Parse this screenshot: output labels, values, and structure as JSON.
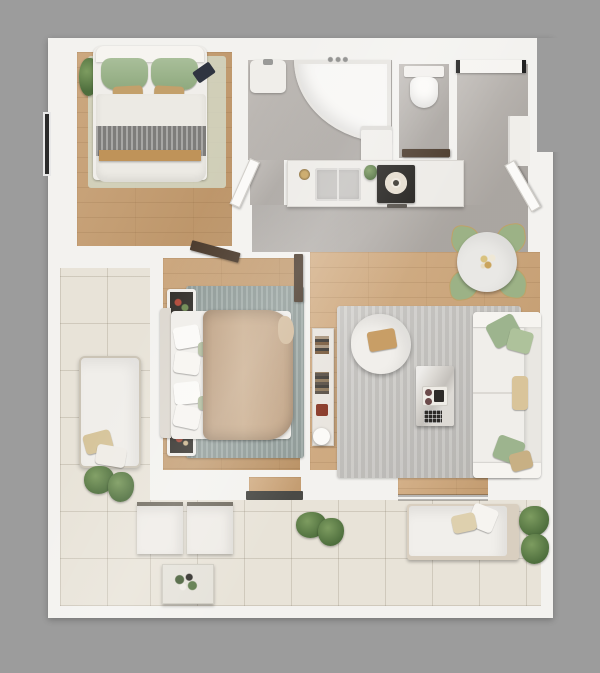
{
  "meta": {
    "title": "apartment-floor-plan-top-view-render",
    "canvas": {
      "width": 600,
      "height": 673
    },
    "visible_text": []
  },
  "palette": {
    "background": "#9c9c9c",
    "wall_white": "#f3f2ef",
    "wood_floor": "#cda476",
    "wood_floor_bedroom": "#c49a6b",
    "concrete_gray": "#b7b2ad",
    "terrace_tile": "#e8e3d8",
    "rug_living": "#c7c5c1",
    "rug_bedroom2": "#98a4a0",
    "rug_bedroom1": "#d4d8c6",
    "sage_green": "#9db48e",
    "tan": "#c3a06b",
    "camel_blanket": "#c4a98b",
    "gray_throw": "#8f8e8c",
    "door_walnut": "#4b3b2d",
    "cooktop_black": "#24221f",
    "brass": "#b08d4f",
    "plant_green": "#5d7a4a",
    "white_fabric": "#f0eeea",
    "marble": "#e9e8e5",
    "window_frame": "#2a2a2a"
  },
  "rooms": [
    {
      "id": "bedroom-1",
      "floor": "wood",
      "position": "top-left"
    },
    {
      "id": "bathroom",
      "floor": "concrete",
      "position": "top-center"
    },
    {
      "id": "wc",
      "floor": "concrete",
      "position": "top-right"
    },
    {
      "id": "entry-hall",
      "floor": "concrete",
      "position": "top-right"
    },
    {
      "id": "corridor-kitchen",
      "floor": "concrete",
      "position": "center"
    },
    {
      "id": "bedroom-2",
      "floor": "wood",
      "position": "center-left"
    },
    {
      "id": "living-dining",
      "floor": "wood",
      "position": "center-right"
    },
    {
      "id": "terrace",
      "floor": "tile",
      "position": "left-and-bottom"
    }
  ],
  "furniture": {
    "bedroom_1": [
      "double-bed-green-pillows",
      "gray-throw",
      "foot-bench",
      "rug",
      "plant",
      "tablet",
      "window",
      "door"
    ],
    "bathroom": [
      "corner-bathtub",
      "vanity-sink",
      "washing-machine",
      "door"
    ],
    "wc": [
      "wall-hung-toilet",
      "door"
    ],
    "entry_hall": [
      "entry-door",
      "wardrobe",
      "interior-door"
    ],
    "kitchen": [
      "counter",
      "double-sink",
      "brass-faucet",
      "cooktop",
      "plant"
    ],
    "dining": [
      "round-marble-table",
      "four-sage-chairs",
      "centerpiece"
    ],
    "living": [
      "sofa-with-pillows",
      "boucle-armchair",
      "marble-coffee-table",
      "media-console",
      "lamp",
      "rug"
    ],
    "bedroom_2": [
      "double-bed-camel-blanket",
      "two-nightstands",
      "rug",
      "door"
    ],
    "terrace": [
      "lounge-chair",
      "two-outdoor-chairs",
      "outdoor-coffee-table",
      "daybed",
      "plants",
      "sliding-door-thresholds"
    ]
  }
}
